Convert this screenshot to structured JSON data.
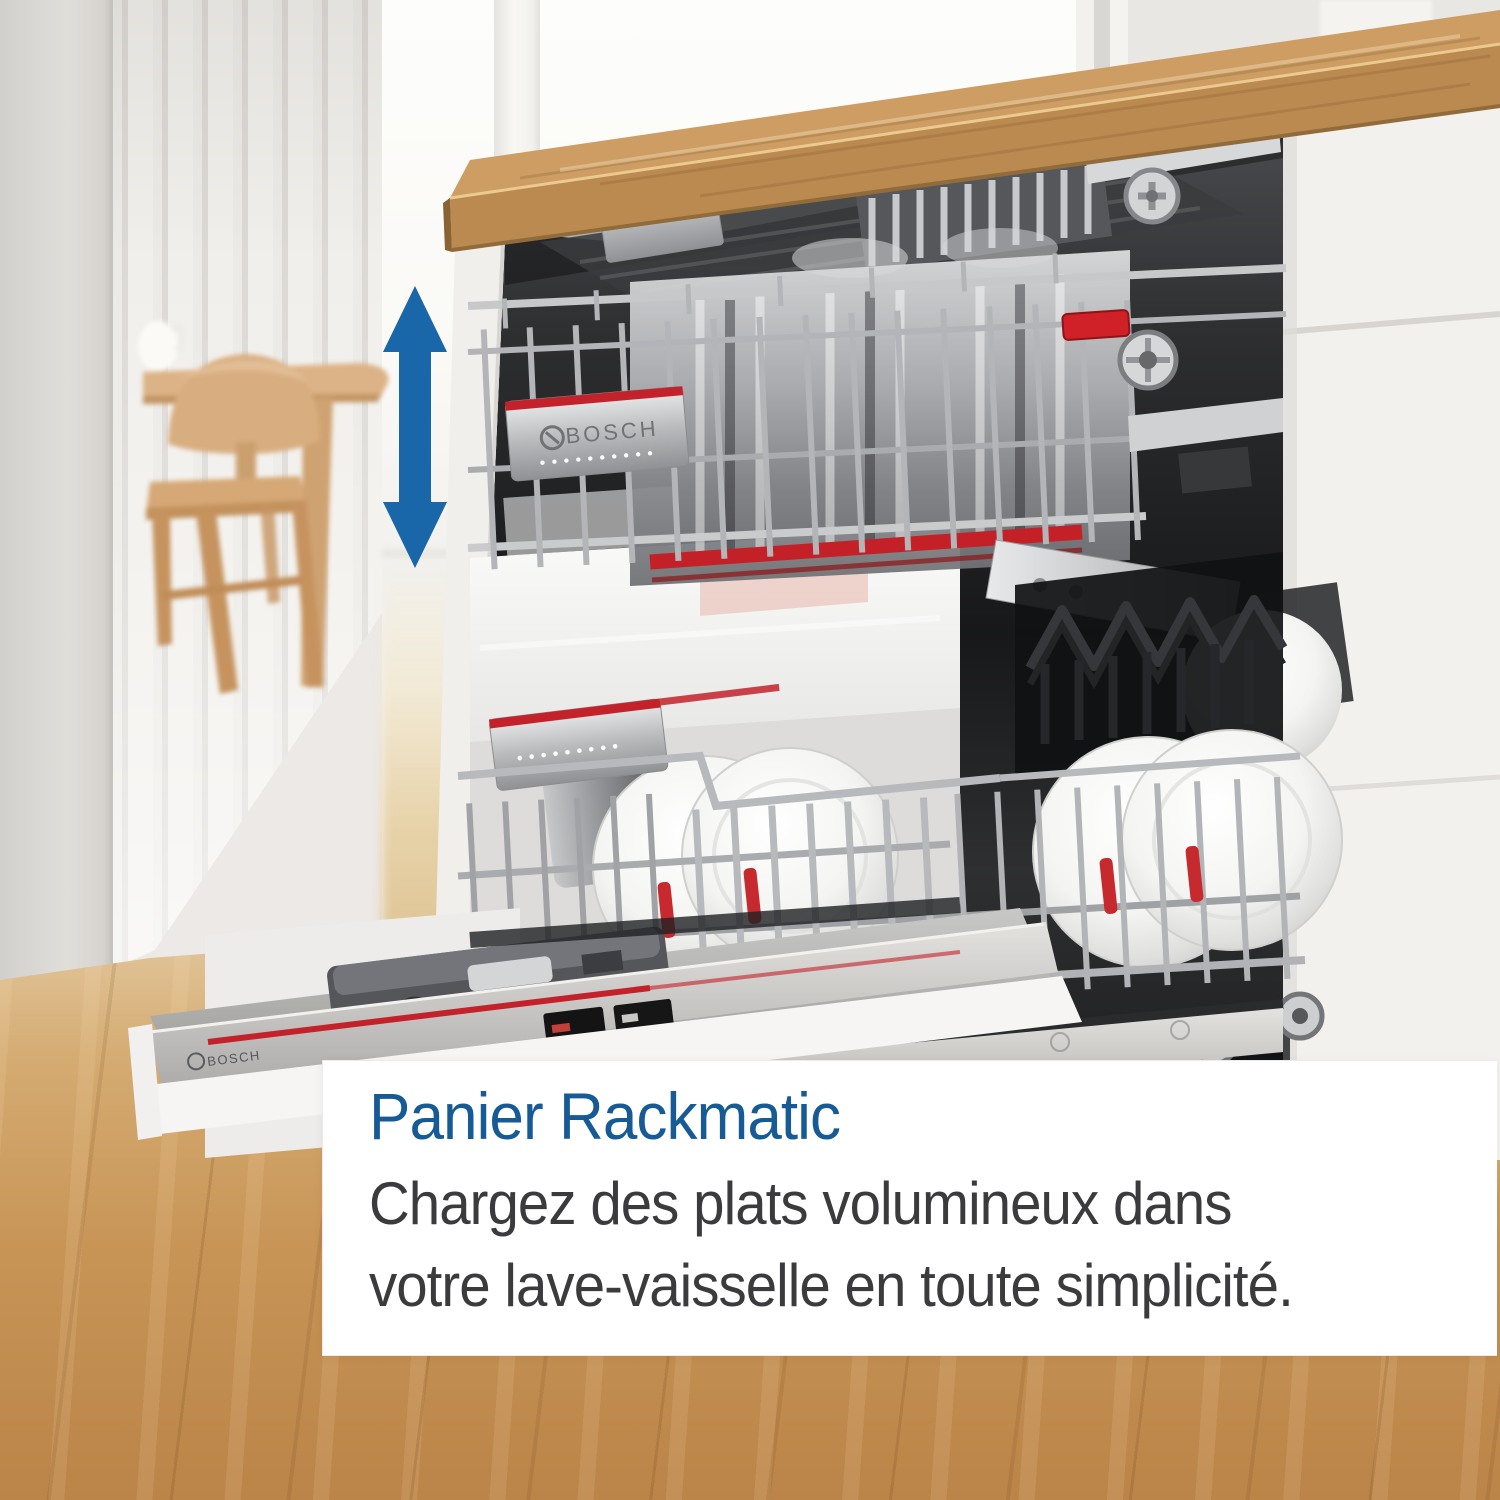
{
  "brand": {
    "name": "BOSCH"
  },
  "caption": {
    "title": "Panier Rackmatic",
    "body_lines": [
      "Chargez des plats volumineux dans",
      "votre lave-vaisselle en toute simplicité."
    ]
  },
  "icons": {
    "height_adjust_arrow": "vertical-double-arrow-icon"
  },
  "colors": {
    "accent-blue": "#1966a8",
    "title-blue": "#165a96",
    "body-text": "#3b3b3d",
    "bosch-red": "#c4222b",
    "counter-wood": "#bb8a50",
    "floor-wood": "#c79a62",
    "cabinet-white": "#f2f1ee",
    "box-bg": "#ffffff"
  }
}
